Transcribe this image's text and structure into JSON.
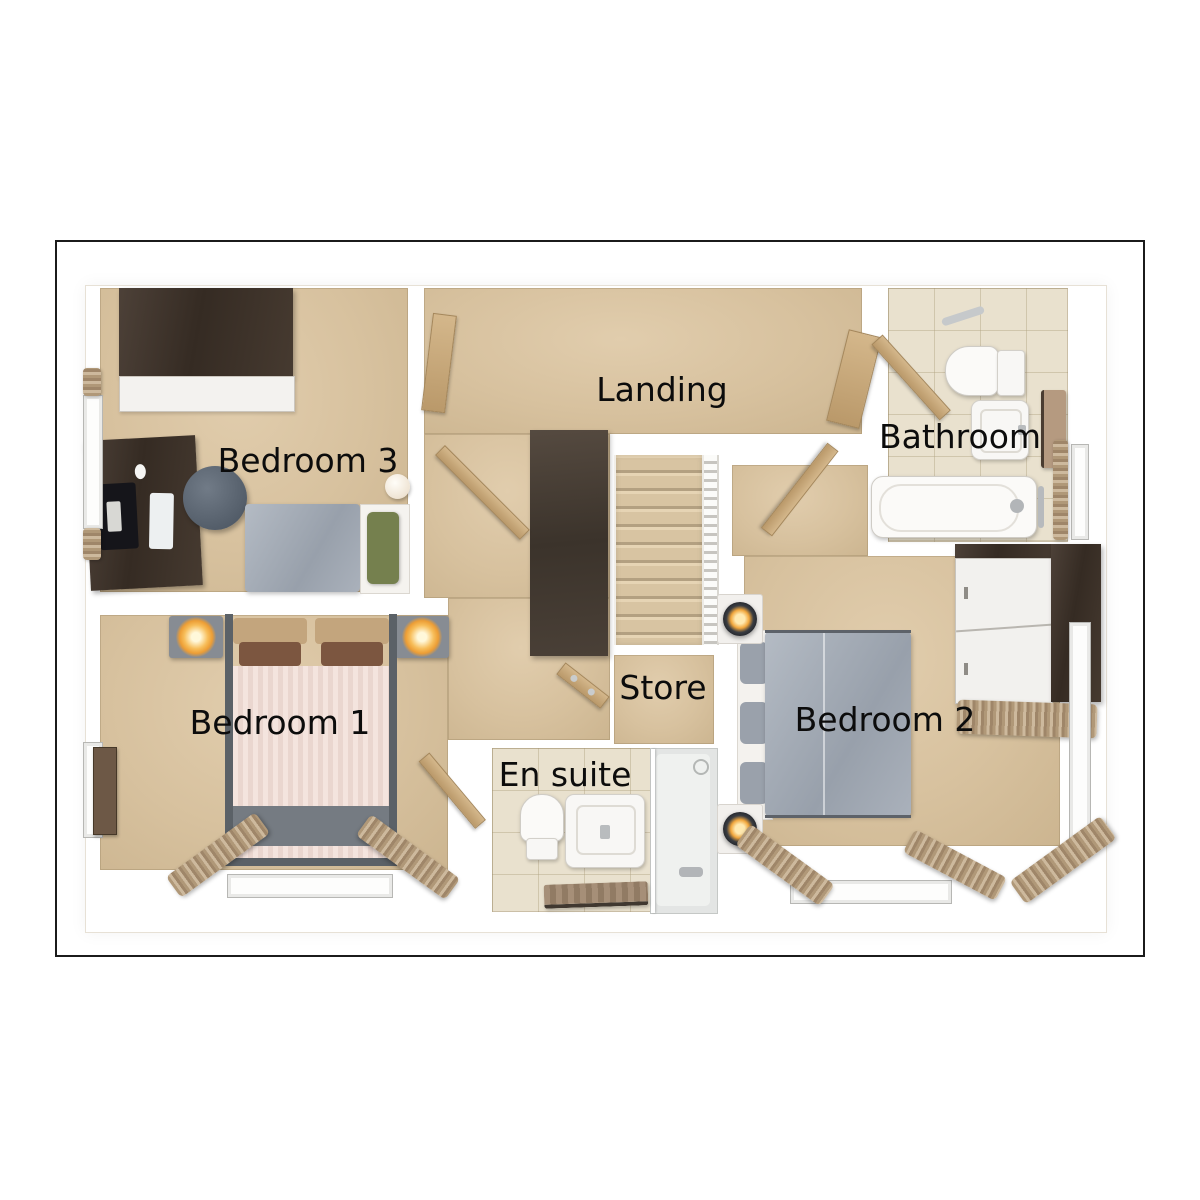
{
  "floorplan": {
    "rooms": {
      "landing": {
        "label": "Landing"
      },
      "bedroom1": {
        "label": "Bedroom 1"
      },
      "bedroom2": {
        "label": "Bedroom 2"
      },
      "bedroom3": {
        "label": "Bedroom 3"
      },
      "bathroom": {
        "label": "Bathroom"
      },
      "ensuite": {
        "label": "En suite"
      },
      "store": {
        "label": "Store"
      }
    },
    "colors": {
      "background": "#ffffff",
      "plan_border": "#1b1b1b",
      "carpet": "#d8c2a0",
      "tile": "#e9e1ce",
      "wall": "#ffffff",
      "dark_wood": "#3c3128",
      "door_wood": "#c8ab7d",
      "bed_gray": "#a4abb5",
      "bed_pink": "#eedad3",
      "lamp_glow": "#f2a73d",
      "label_text": "#0c0c0c"
    }
  }
}
